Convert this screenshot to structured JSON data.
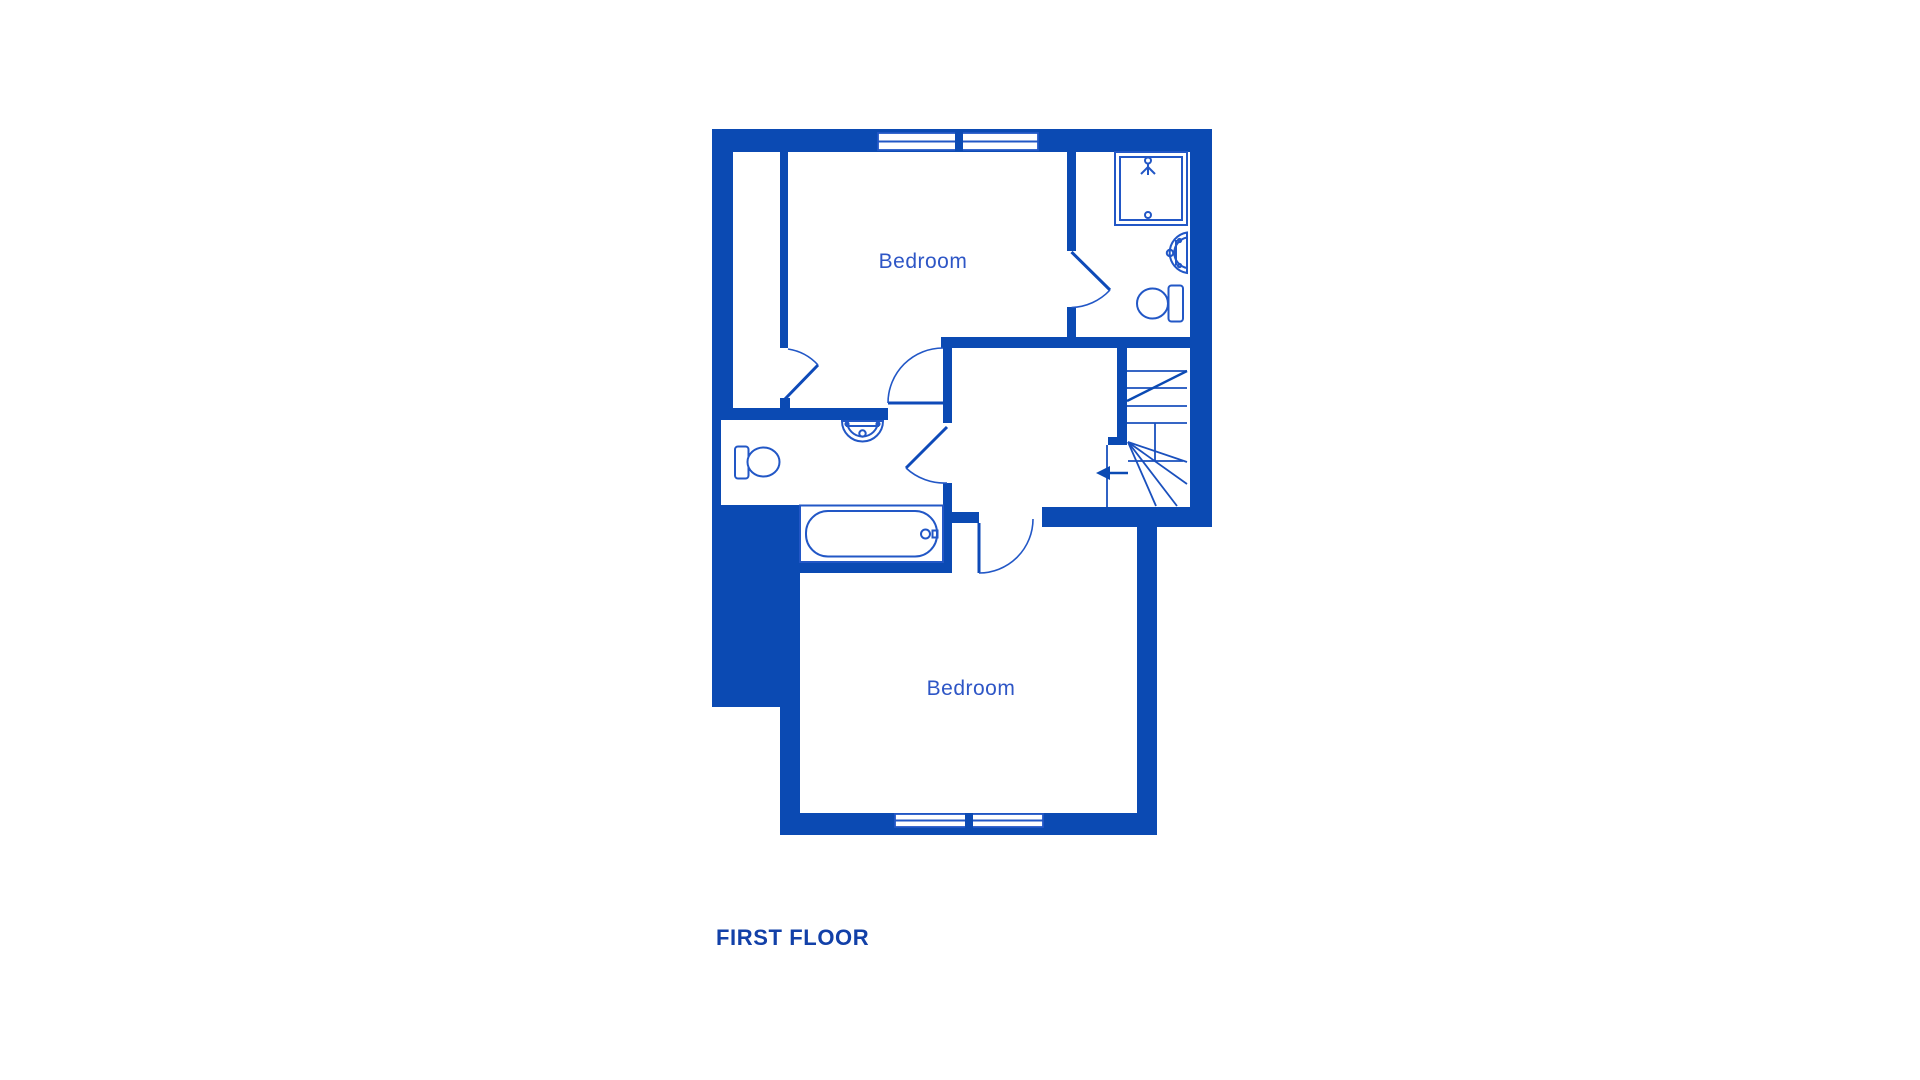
{
  "title": {
    "text": "FIRST FLOOR"
  },
  "labels": {
    "bedroom_top": "Bedroom",
    "bedroom_bottom": "Bedroom"
  },
  "colors": {
    "wall_fill": "#0b4ab3",
    "fixture_line": "#2257c6",
    "room_label_text": "#2e56c6",
    "title_text": "#1240a8",
    "background": "#ffffff"
  },
  "floorplan": {
    "rooms_labeled": [
      "Bedroom",
      "Bedroom"
    ],
    "fixtures": [
      "shower-enclosure-icon",
      "shower-head-icon",
      "washbasin-icon-ensuite",
      "toilet-icon-ensuite",
      "washbasin-icon-bathroom",
      "toilet-icon-bathroom",
      "bathtub-icon",
      "staircase-winder-icon",
      "stair-direction-arrow-icon"
    ],
    "windows": {
      "top_wall": 2,
      "bottom_wall": 2
    },
    "doors": 5
  }
}
